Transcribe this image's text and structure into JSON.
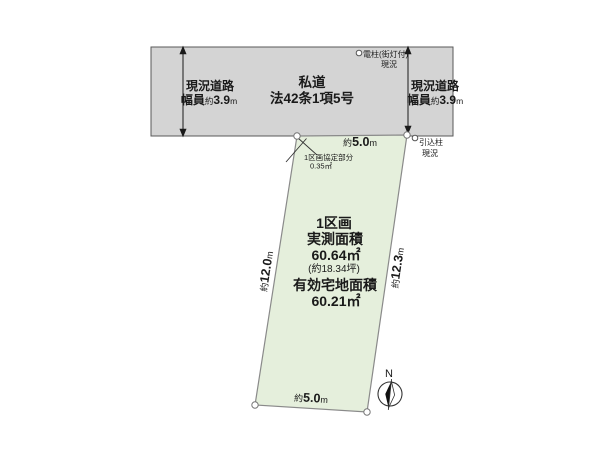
{
  "road": {
    "label_line1": "私道",
    "label_line2": "法42条1項5号",
    "left": {
      "line1": "現況道路",
      "width_label": "幅員",
      "approx": "約",
      "value": "3.9",
      "unit": "m"
    },
    "right": {
      "line1": "現況道路",
      "width_label": "幅員",
      "approx": "約",
      "value": "3.9",
      "unit": "m"
    }
  },
  "parcel": {
    "name": "1区画",
    "measured_area_label": "実測面積",
    "measured_area": "60.64㎡",
    "tsubo": "(約18.34坪)",
    "effective_area_label": "有効宅地面積",
    "effective_area": "60.21㎡"
  },
  "dimensions": {
    "top": {
      "approx": "約",
      "value": "5.0",
      "unit": "m"
    },
    "bottom": {
      "approx": "約",
      "value": "5.0",
      "unit": "m"
    },
    "left": {
      "approx": "約",
      "value": "12.0",
      "unit": "m"
    },
    "right": {
      "approx": "約",
      "value": "12.3",
      "unit": "m"
    }
  },
  "annotations": {
    "utility_pole": {
      "line1": "電柱(街灯付)",
      "line2": "現況"
    },
    "service_pole": {
      "line1": "引込柱",
      "line2": "現況"
    },
    "agreement_area": {
      "line1": "1区画協定部分",
      "line2": "0.35㎡"
    }
  },
  "compass": {
    "label": "N"
  },
  "colors": {
    "road_fill": "#d4d4d4",
    "parcel_fill": "#e5efdc",
    "outline": "#595959"
  }
}
